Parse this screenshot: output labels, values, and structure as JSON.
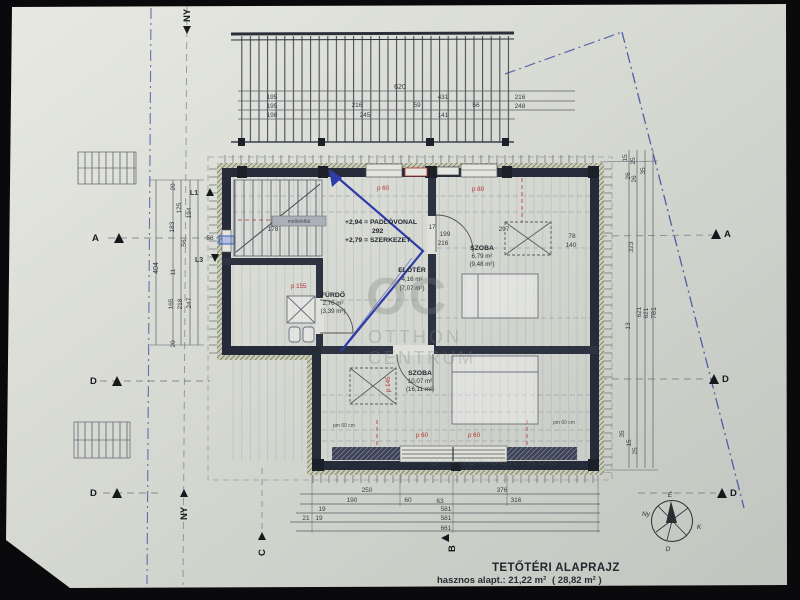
{
  "title_block": {
    "title": "TETŐTÉRI ALAPRAJZ",
    "area_label": "hasznos alapt.: 21,22 m²",
    "area_secondary": "( 28,82 m² )"
  },
  "rooms": [
    {
      "name": "ELŐTÉR",
      "area_net": "4,16 m²",
      "area_gross": "(7,07 m²)"
    },
    {
      "name": "SZOBA",
      "area_net": "6,79 m²",
      "area_gross": "(9,48 m²)"
    },
    {
      "name": "FÜRDŐ",
      "area_net": "2,70 m²",
      "area_gross": "(3,39 m²)"
    },
    {
      "name": "SZOBA",
      "area_net": "10,07 m²",
      "area_gross": "(16,11 m²)"
    }
  ],
  "levels": {
    "floor_line": "+2,94 = PADLÓVONAL",
    "floor_height": "292",
    "structure_line": "+2,79 = SZERKEZET"
  },
  "labels": {
    "parapet_wall": "mellvédfal",
    "p60_top": "p 60",
    "p80_top": "p 80",
    "p155": "p 155",
    "p145": "p 145",
    "p60_bottom_1": "p 60",
    "p60_bottom_2": "p 60",
    "pm60_left": "pm 60 cm",
    "pm60_right": "pm 60 cm"
  },
  "axes": {
    "a": "A",
    "d": "D",
    "ny": "NY",
    "c": "C",
    "b": "B",
    "l1": "L1",
    "l3": "L3"
  },
  "compass": {
    "north": "É",
    "south": "D",
    "east": "K",
    "west": "Ny"
  },
  "watermark": {
    "logo": "OC",
    "line1": "OTTHON",
    "line2": "CENTRUM"
  },
  "dims": {
    "top": [
      "620",
      "195",
      "216",
      "59",
      "431",
      "56",
      "216",
      "195",
      "245",
      "141",
      "248",
      "198"
    ],
    "left": [
      "404",
      "20",
      "125",
      "194",
      "183",
      "56",
      "58",
      "11",
      "165",
      "218",
      "247",
      "20"
    ],
    "right": [
      "15",
      "25",
      "35",
      "26",
      "26",
      "78",
      "140",
      "323",
      "13",
      "621",
      "621",
      "781",
      "35",
      "15",
      "25"
    ],
    "bottom": [
      "250",
      "376",
      "190",
      "60",
      "63",
      "316",
      "19",
      "581",
      "21",
      "19",
      "581",
      "661"
    ],
    "interior": [
      "178",
      "297",
      "17",
      "199",
      "216"
    ]
  },
  "colors": {
    "paper": "#d5d7d0",
    "ink": "#2b2f3a",
    "wall": "#262b39",
    "blue_line": "#3b4aa0",
    "red": "#b23232",
    "watermark": "#79817b"
  }
}
